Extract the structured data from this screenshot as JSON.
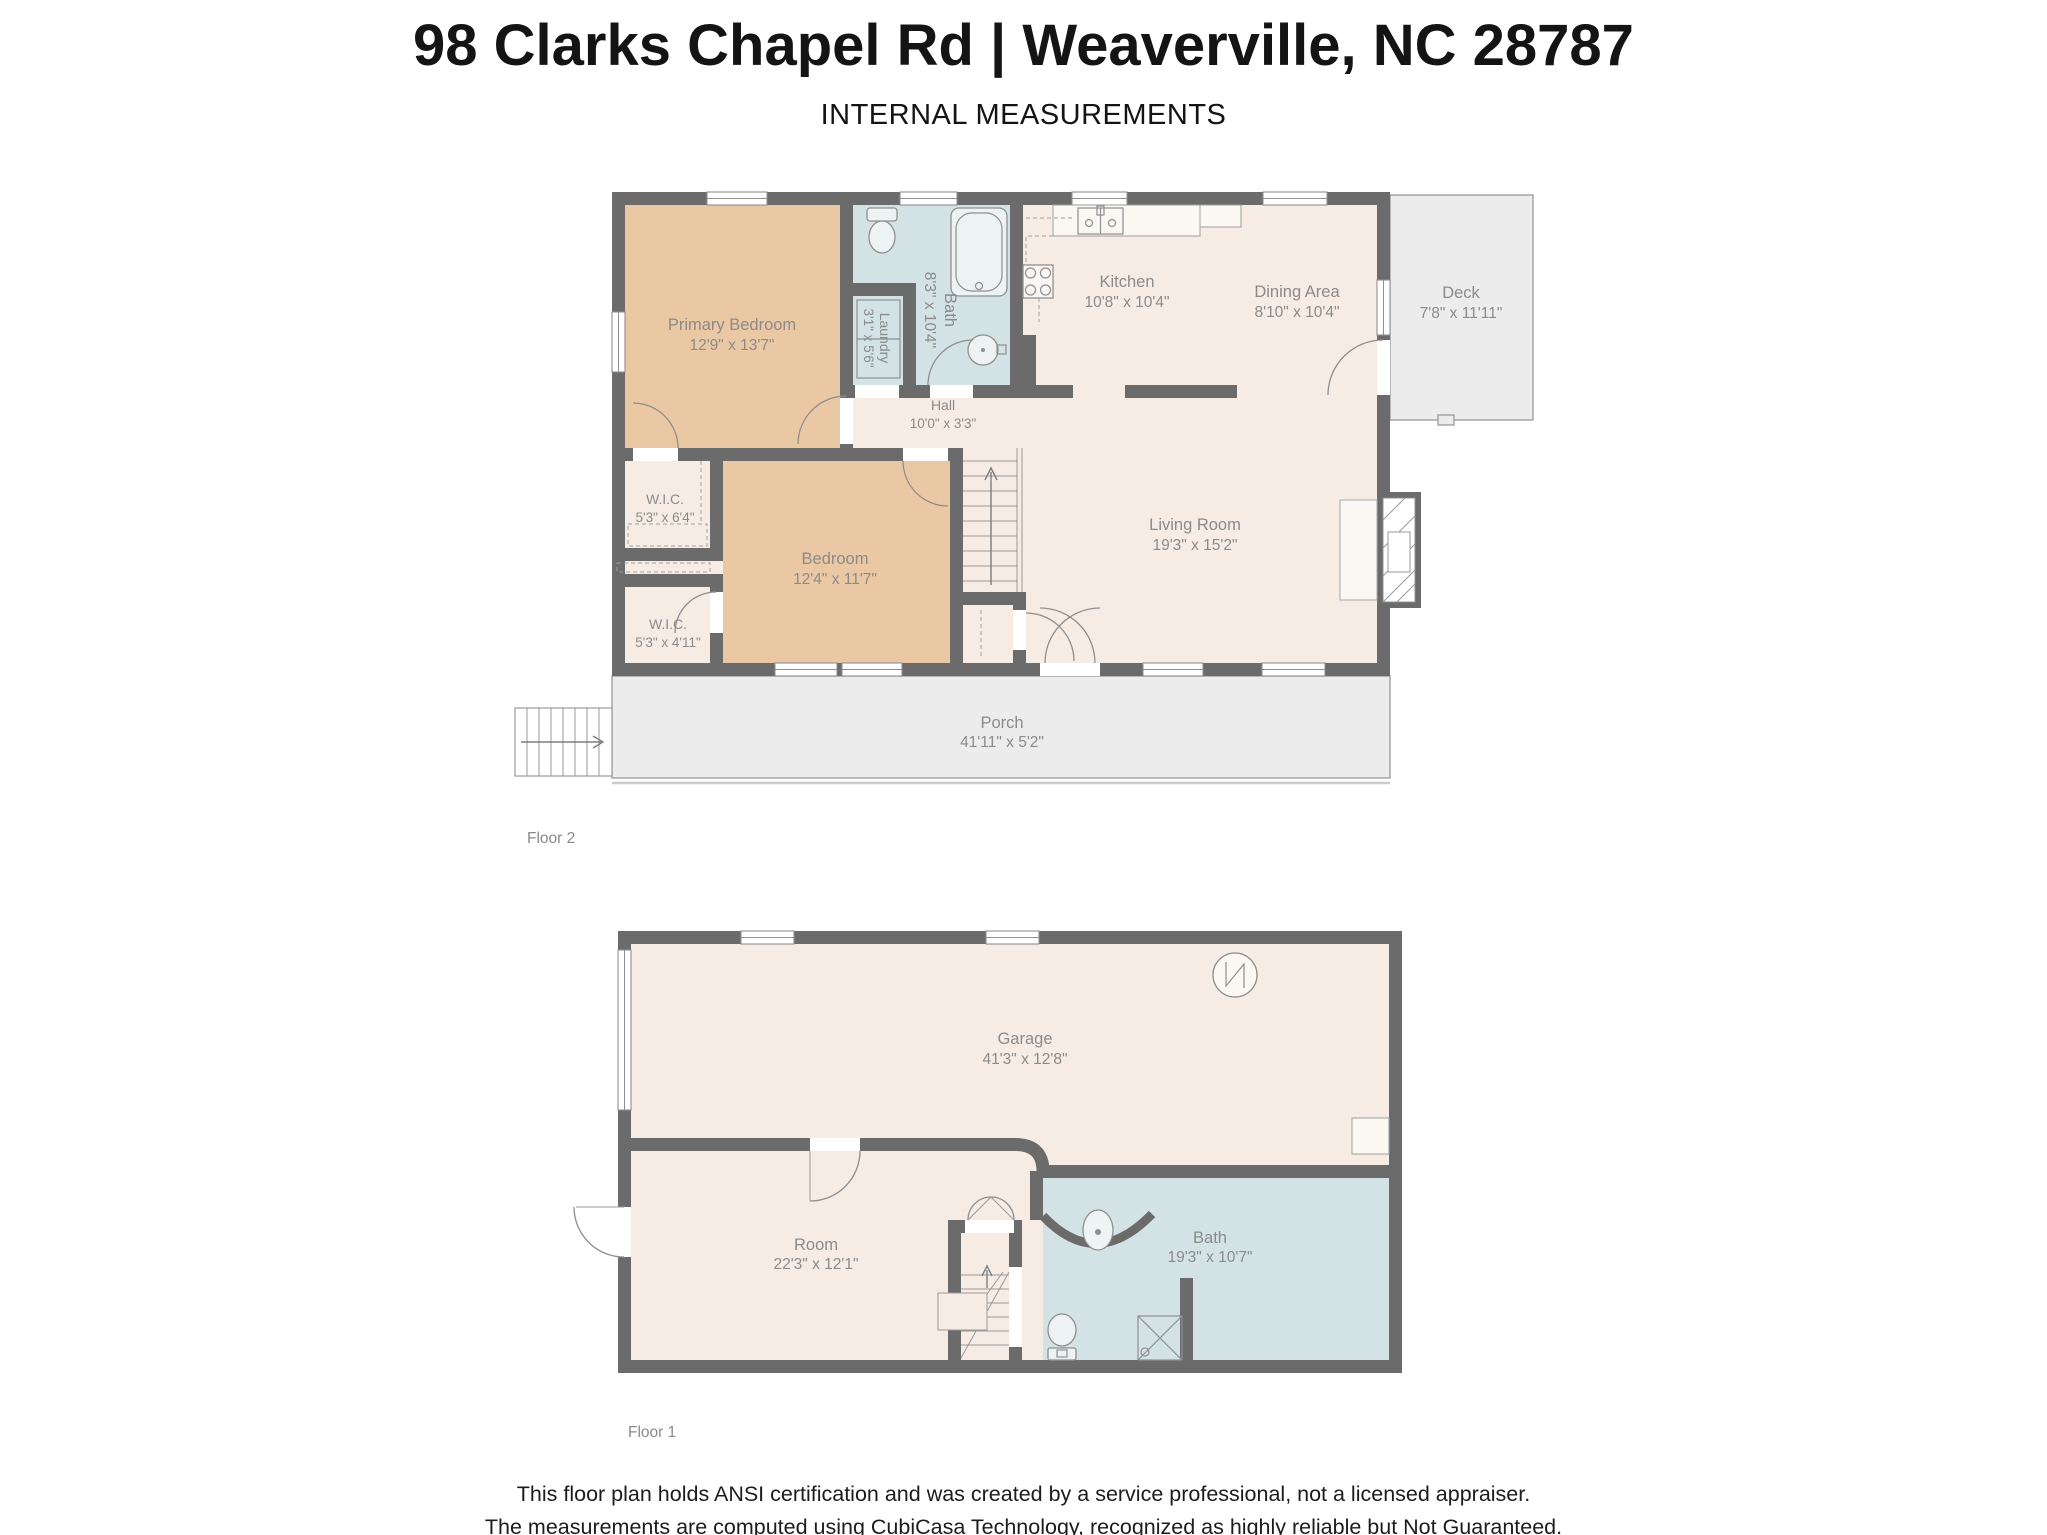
{
  "header": {
    "title": "98 Clarks Chapel Rd | Weaverville, NC 28787",
    "subtitle": "INTERNAL MEASUREMENTS"
  },
  "floor2": {
    "label": "Floor 2",
    "rooms": {
      "primary_bedroom": {
        "name": "Primary Bedroom",
        "dims": "12'9\" x 13'7\""
      },
      "bath": {
        "name": "Bath",
        "dims": "8'3\" x 10'4\""
      },
      "laundry": {
        "name": "Laundry",
        "dims": "3'1\" x 5'6\""
      },
      "kitchen": {
        "name": "Kitchen",
        "dims": "10'8\" x 10'4\""
      },
      "dining": {
        "name": "Dining Area",
        "dims": "8'10\" x 10'4\""
      },
      "deck": {
        "name": "Deck",
        "dims": "7'8\" x 11'11\""
      },
      "hall": {
        "name": "Hall",
        "dims": "10'0\" x 3'3\""
      },
      "wic_upper": {
        "name": "W.I.C.",
        "dims": "5'3\" x 6'4\""
      },
      "bedroom": {
        "name": "Bedroom",
        "dims": "12'4\" x 11'7\""
      },
      "wic_lower": {
        "name": "W.I.C.",
        "dims": "5'3\" x 4'11\""
      },
      "living": {
        "name": "Living Room",
        "dims": "19'3\" x 15'2\""
      },
      "porch": {
        "name": "Porch",
        "dims": "41'11\" x 5'2\""
      }
    }
  },
  "floor1": {
    "label": "Floor 1",
    "rooms": {
      "garage": {
        "name": "Garage",
        "dims": "41'3\" x 12'8\""
      },
      "room": {
        "name": "Room",
        "dims": "22'3\" x 12'1\""
      },
      "bath": {
        "name": "Bath",
        "dims": "19'3\" x 10'7\""
      }
    }
  },
  "footer": {
    "line1": "This floor plan holds ANSI certification and was created by a service professional, not a licensed appraiser.",
    "line2": "The measurements are computed using CubiCasa Technology, recognized as highly reliable but Not Guaranteed."
  },
  "colors": {
    "wall": "#6b6b6b",
    "bedroom_fill": "#eac8a3",
    "wet_room_fill": "#d3e2e4",
    "interior_fill": "#f6ece4",
    "outdoor_fill": "#ececec",
    "label_text": "#8b8b8b",
    "title_text": "#141414"
  }
}
